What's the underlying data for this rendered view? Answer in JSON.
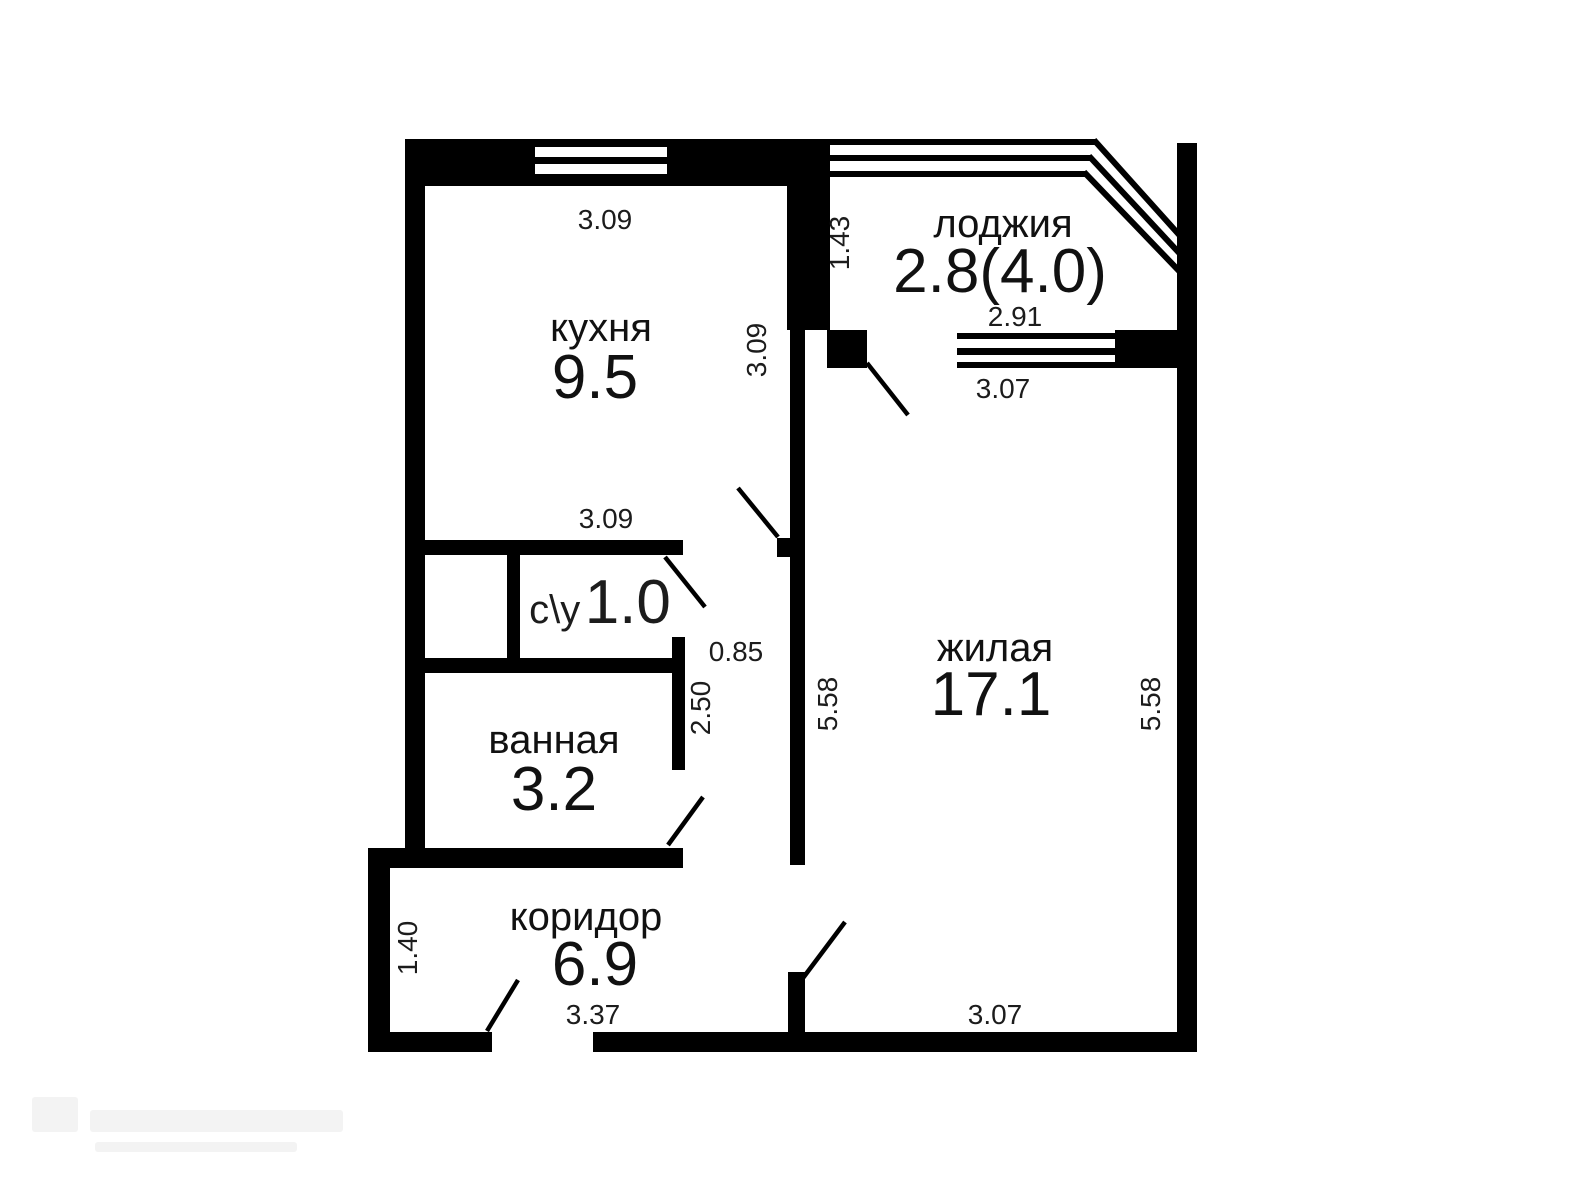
{
  "rooms": {
    "kitchen": {
      "name": "кухня",
      "area": "9.5"
    },
    "loggia": {
      "name": "лоджия",
      "area": "2.8(4.0)"
    },
    "living": {
      "name": "жилая",
      "area": "17.1"
    },
    "wc": {
      "name": "с\\у",
      "area": "1.0"
    },
    "bathroom": {
      "name": "ванная",
      "area": "3.2"
    },
    "corridor": {
      "name": "коридор",
      "area": "6.9"
    }
  },
  "dimensions": {
    "kitchen_width_top": "3.09",
    "kitchen_height_right": "3.09",
    "loggia_depth": "1.43",
    "loggia_width": "2.91",
    "living_width_top": "3.07",
    "wc_width_top": "3.09",
    "passage_width": "0.85",
    "passage_length": "2.50",
    "living_height_left": "5.58",
    "living_height_right": "5.58",
    "corridor_depth": "1.40",
    "corridor_width": "3.37",
    "living_width_bottom": "3.07"
  },
  "colors": {
    "walls": "#000000",
    "text": "#1c1c1c",
    "background": "#ffffff"
  }
}
